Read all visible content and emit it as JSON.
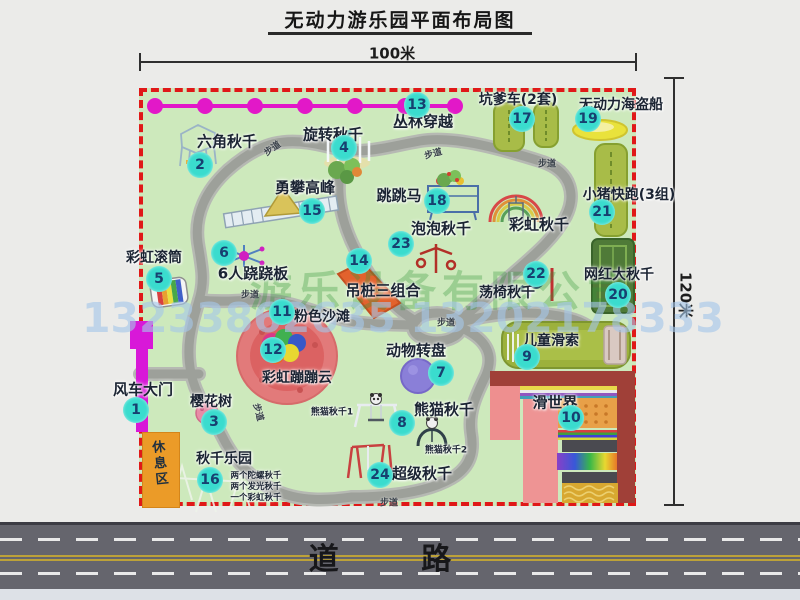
{
  "title": "无动力游乐园平面布局图",
  "dimension_top": "100米",
  "dimension_right": "120米",
  "road_label": "道  路",
  "rest_area": "休息区",
  "path_label_text": "步道",
  "watermark": {
    "company": "游乐设备有限公司",
    "phone": "13233862635 13202178333"
  },
  "attractions": [
    {
      "n": 1,
      "name": "风车大门",
      "marker": [
        136,
        410
      ],
      "label": [
        143,
        389
      ],
      "fs": 15
    },
    {
      "n": 2,
      "name": "六角秋千",
      "marker": [
        200,
        165
      ],
      "label": [
        227,
        141
      ],
      "fs": 15
    },
    {
      "n": 3,
      "name": "樱花树",
      "marker": [
        214,
        422
      ],
      "label": [
        211,
        401
      ],
      "fs": 14
    },
    {
      "n": 4,
      "name": "旋转秋千",
      "marker": [
        344,
        148
      ],
      "label": [
        333,
        134
      ],
      "fs": 15
    },
    {
      "n": 5,
      "name": "彩虹滚筒",
      "marker": [
        159,
        279
      ],
      "label": [
        154,
        257
      ],
      "fs": 14
    },
    {
      "n": 6,
      "name": "6人跷跷板",
      "marker": [
        224,
        253
      ],
      "label": [
        253,
        273
      ],
      "fs": 15
    },
    {
      "n": 7,
      "name": "动物转盘",
      "marker": [
        441,
        373
      ],
      "label": [
        416,
        350
      ],
      "fs": 15
    },
    {
      "n": 8,
      "name": "熊猫秋千",
      "marker": [
        402,
        423
      ],
      "label": [
        444,
        409
      ],
      "fs": 15
    },
    {
      "n": 9,
      "name": "儿童滑索",
      "marker": [
        527,
        357
      ],
      "label": [
        551,
        340
      ],
      "fs": 14
    },
    {
      "n": 10,
      "name": "滑世界",
      "marker": [
        571,
        418
      ],
      "label": [
        555,
        402
      ],
      "fs": 15
    },
    {
      "n": 11,
      "name": "粉色沙滩",
      "marker": [
        282,
        312
      ],
      "label": [
        322,
        316
      ],
      "fs": 14
    },
    {
      "n": 12,
      "name": "彩虹蹦蹦云",
      "marker": [
        273,
        350
      ],
      "label": [
        297,
        377
      ],
      "fs": 14
    },
    {
      "n": 13,
      "name": "丛林穿越",
      "marker": [
        417,
        105
      ],
      "label": [
        423,
        121
      ],
      "fs": 15
    },
    {
      "n": 14,
      "name": "吊桩三组合",
      "marker": [
        359,
        261
      ],
      "label": [
        383,
        290
      ],
      "fs": 15
    },
    {
      "n": 15,
      "name": "勇攀高峰",
      "marker": [
        312,
        211
      ],
      "label": [
        305,
        187
      ],
      "fs": 15
    },
    {
      "n": 16,
      "name": "秋千乐园",
      "marker": [
        210,
        480
      ],
      "label": [
        224,
        458
      ],
      "fs": 14
    },
    {
      "n": 17,
      "name": "坑爹车(2套)",
      "marker": [
        522,
        119
      ],
      "label": [
        518,
        99
      ],
      "fs": 14
    },
    {
      "n": 18,
      "name": "跳跳马",
      "marker": [
        437,
        201
      ],
      "label": [
        399,
        195
      ],
      "fs": 15
    },
    {
      "n": 19,
      "name": "无动力海盗船",
      "marker": [
        588,
        119
      ],
      "label": [
        621,
        104
      ],
      "fs": 14
    },
    {
      "n": 20,
      "name": "网红大秋千",
      "marker": [
        618,
        295
      ],
      "label": [
        619,
        274
      ],
      "fs": 14
    },
    {
      "n": 21,
      "name": "小猪快跑(3组)",
      "marker": [
        602,
        212
      ],
      "label": [
        629,
        194
      ],
      "fs": 14
    },
    {
      "n": 22,
      "name": "荡椅秋千",
      "marker": [
        536,
        274
      ],
      "label": [
        507,
        292
      ],
      "fs": 14
    },
    {
      "n": 23,
      "name": "泡泡秋千",
      "marker": [
        401,
        244
      ],
      "label": [
        441,
        228
      ],
      "fs": 15
    },
    {
      "n": 24,
      "name": "超级秋千",
      "marker": [
        380,
        475
      ],
      "label": [
        422,
        473
      ],
      "fs": 15
    }
  ],
  "extra_labels": [
    {
      "text": "彩虹秋千",
      "x": 539,
      "y": 224,
      "fs": 15
    },
    {
      "text": "熊猫秋千1",
      "x": 332,
      "y": 411,
      "fs": 9
    },
    {
      "text": "熊猫秋千2",
      "x": 446,
      "y": 449,
      "fs": 9
    },
    {
      "text": "两个陀螺秋千",
      "x": 256,
      "y": 475,
      "fs": 8.5
    },
    {
      "text": "两个发光秋千",
      "x": 256,
      "y": 486,
      "fs": 8.5
    },
    {
      "text": "一个彩虹秋千",
      "x": 256,
      "y": 497,
      "fs": 8.5
    }
  ],
  "path_labels": [
    {
      "x": 272,
      "y": 148,
      "r": -35
    },
    {
      "x": 433,
      "y": 153,
      "r": -15
    },
    {
      "x": 547,
      "y": 163,
      "r": 0
    },
    {
      "x": 250,
      "y": 294,
      "r": 0
    },
    {
      "x": 446,
      "y": 322,
      "r": 0
    },
    {
      "x": 389,
      "y": 502,
      "r": 0
    },
    {
      "x": 259,
      "y": 412,
      "r": 75
    }
  ],
  "colors": {
    "park_green": "#cde9bc",
    "border_red": "#e01818",
    "marker_cyan": "#3adcce",
    "magenta": "#e218c8",
    "path_gray": "#9da09a",
    "road_gray": "#65656d"
  }
}
